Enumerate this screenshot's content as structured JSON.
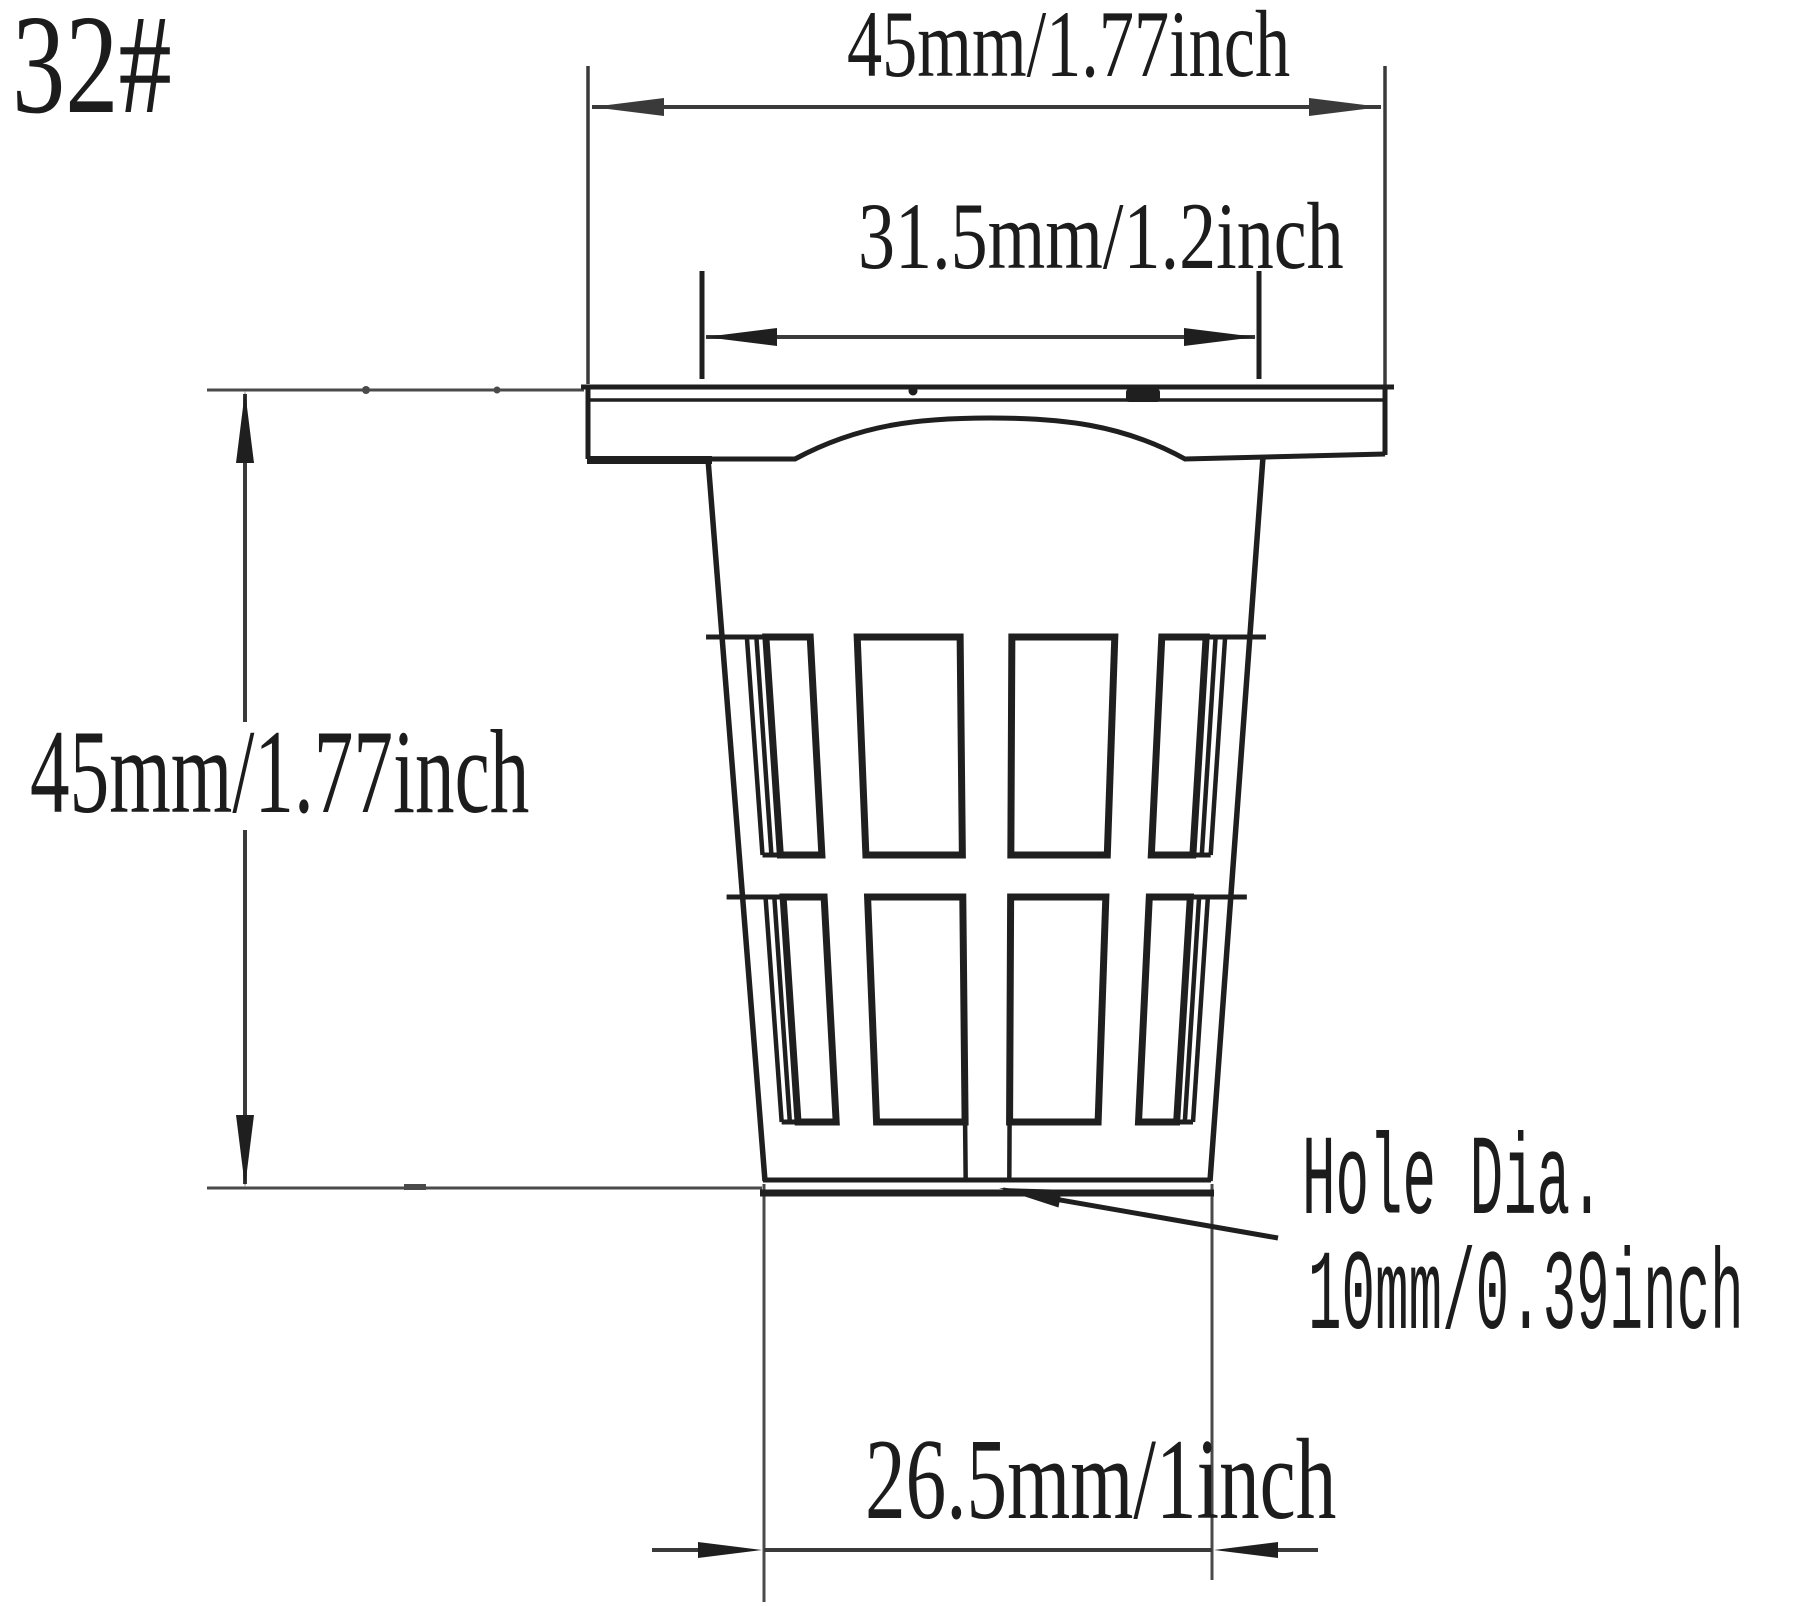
{
  "part_label": "32#",
  "dimensions": {
    "top_width": "45mm/1.77inch",
    "inner_width": "31.5mm/1.2inch",
    "height": "45mm/1.77inch",
    "bottom_width": "26.5mm/1inch"
  },
  "hole_annotation": {
    "line1": "Hole Dia.",
    "line2": "10mm/0.39inch"
  },
  "colors": {
    "background": "#ffffff",
    "object_line": "#1f1f1f",
    "dimension_line": "#3a3a3a",
    "extension_line": "#4a4a4a"
  }
}
